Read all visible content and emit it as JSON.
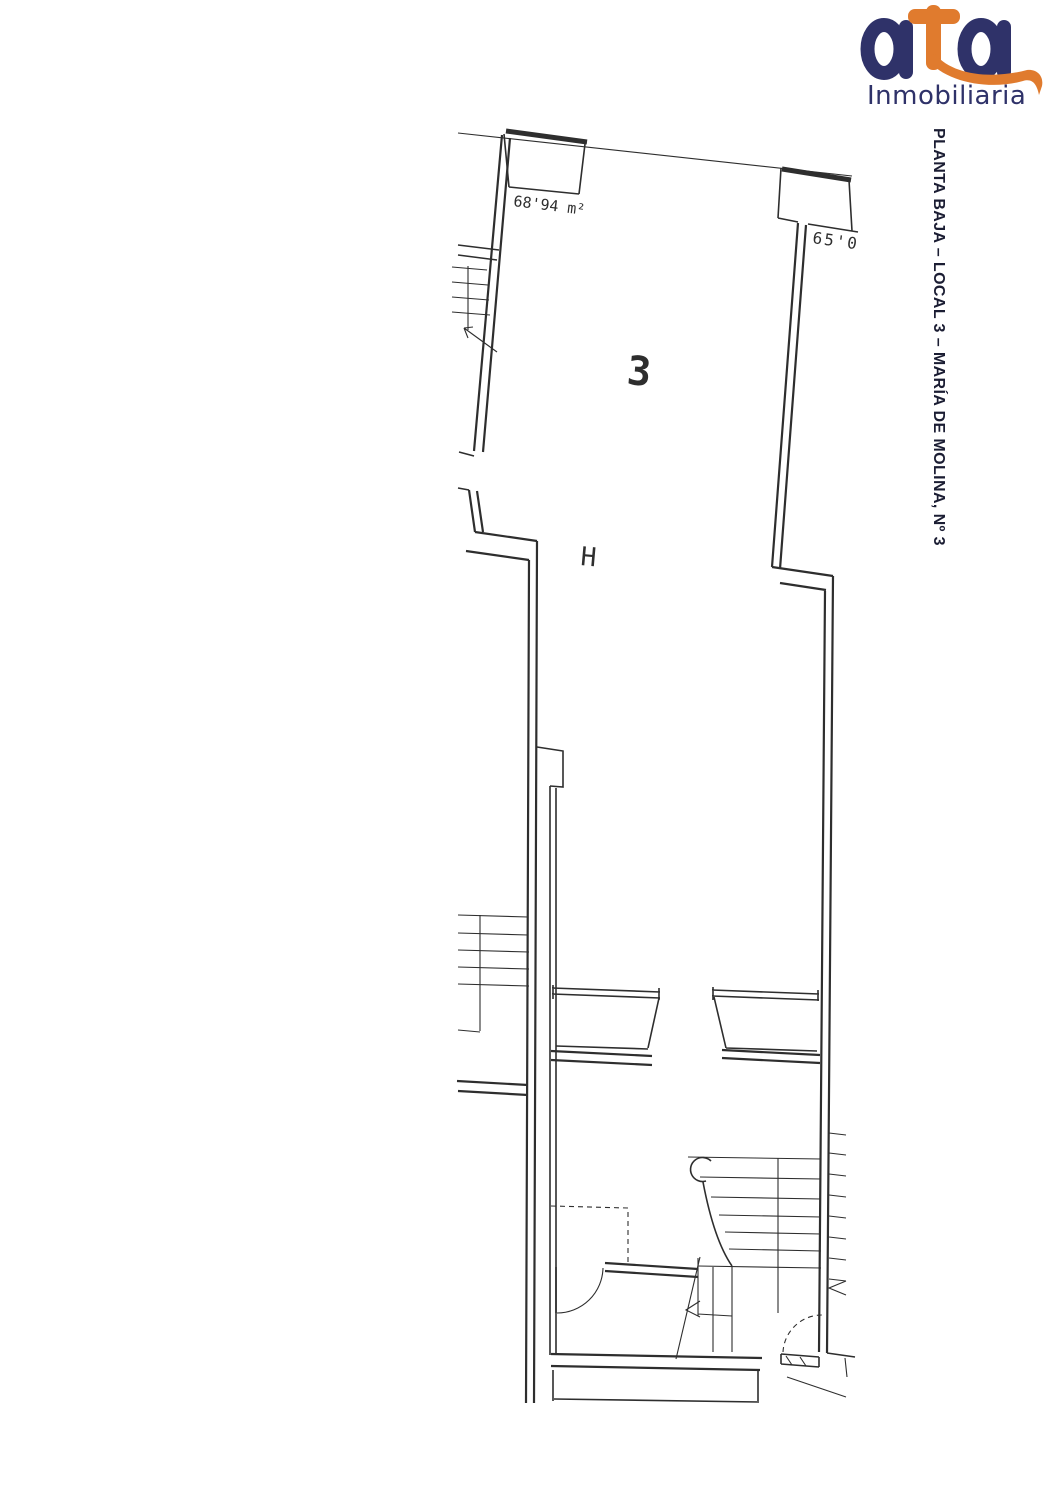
{
  "page": {
    "background": "#ffffff"
  },
  "logo": {
    "word": "ata",
    "subtitle": "Inmobiliaria",
    "navy": "#2f3269",
    "orange": "#e07b2e"
  },
  "title": {
    "text": "PLANTA BAJA – LOCAL 3 – MARÍA DE MOLINA, Nº 3",
    "color": "#1b1d33"
  },
  "plan": {
    "line_color": "#2e2e2e",
    "labels": {
      "area_left": "68'94 m²",
      "area_right": "65'0",
      "unit_number": "3",
      "column_symbol": "H"
    }
  }
}
